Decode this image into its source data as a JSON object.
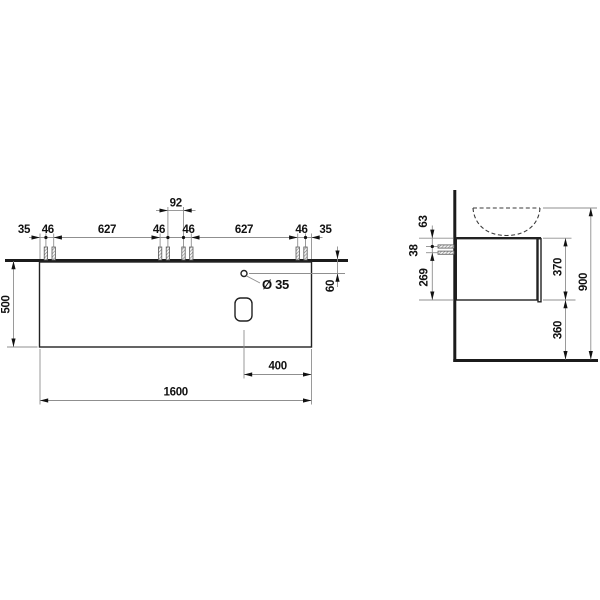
{
  "drawing_title": "vanity-unit-dimension-drawing",
  "colors": {
    "background": "#ffffff",
    "outline": "#1b1b1b",
    "dimension_line": "#8f8f8f",
    "text": "#111111"
  },
  "front_view": {
    "dim_edge_left": "35",
    "dim_dowel_pair_1": "46",
    "dim_span_left": "627",
    "dim_dowel_pair_2": "46",
    "dim_center_gap": "92",
    "dim_dowel_pair_3": "46",
    "dim_span_right": "627",
    "dim_dowel_pair_4": "46",
    "dim_edge_right": "35",
    "dim_front_height": "500",
    "dim_hole_offset": "60",
    "hole_diameter_label": "Ø 35",
    "dim_cutout_offset": "400",
    "dim_total_width": "1600"
  },
  "side_view": {
    "dim_top_to_upper_dowel": "63",
    "dim_dowel_spacing": "38",
    "dim_lower_dowel_to_bottom": "269",
    "dim_cabinet_height": "370",
    "dim_floor_clearance": "360",
    "dim_total_height": "900"
  }
}
